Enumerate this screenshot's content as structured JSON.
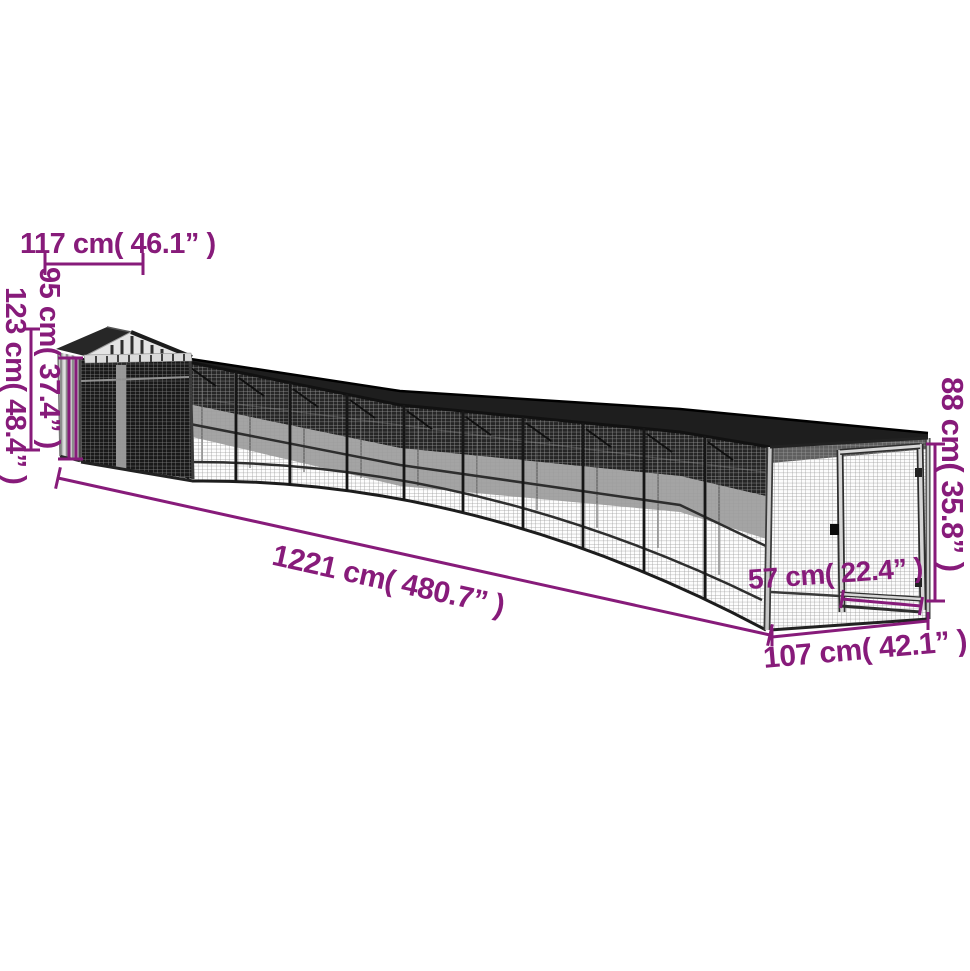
{
  "diagram": {
    "description": "Chicken coop with covered run - dimension drawing",
    "accent_color": "#871b7a",
    "dimensions": {
      "top_width": "117 cm( 46.1” )",
      "wall_height": "95 cm( 37.4” )",
      "total_height": "123 cm( 48.4” )",
      "total_length": "1221 cm( 480.7” )",
      "door_width": "57 cm( 22.4” )",
      "end_width": "107 cm( 42.1” )",
      "run_height": "88 cm( 35.8” )"
    }
  }
}
